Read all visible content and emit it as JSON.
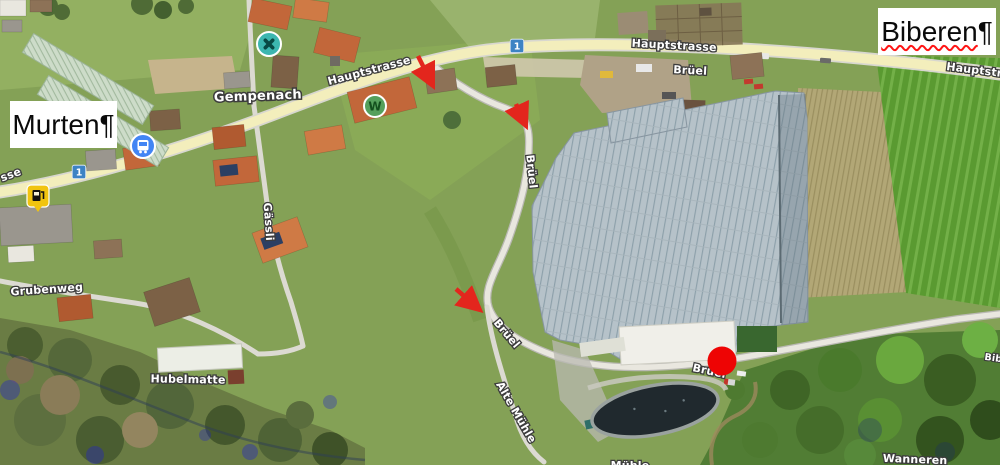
{
  "document": {
    "text_boxes": {
      "murten": {
        "word": "Murten",
        "pilcrow": "¶"
      },
      "biberen": {
        "word": "Biberen",
        "pilcrow": "¶",
        "misspelled": true
      }
    }
  },
  "map": {
    "locality_label": "Gempenach",
    "street_labels": {
      "hauptstrasse_west": "Hauptstrasse",
      "hauptstrasse_north": "Hauptstrasse",
      "hauptstrasse_east_partial": "Hauptstra",
      "strasse_left_partial": "sse",
      "brueel_north": "Brüel",
      "brueel_upper": "Brüel",
      "brueel_mid": "Brüel",
      "brueel_at_marker": "Brüel",
      "gaessli": "Gässli",
      "grubenweg": "Grubenweg",
      "hubelmatte": "Hubelmatte",
      "alte_muehle": "Alte Mühle",
      "muehle_bottom_partial": "Mühle",
      "wanneren": "Wanneren",
      "bibere_right_partial": "Bib"
    },
    "route_shield_number": "1",
    "poi": {
      "w_badge": "W"
    }
  },
  "theme": {
    "arrow_red": "#e3261d",
    "marker_red": "#ee0404",
    "squiggle_red": "#ff1515",
    "road_yellow": "#f3eebc",
    "shield_blue": "#3d83c4",
    "restaurant_teal": "#3cb6b0",
    "poi_green": "#55a05c",
    "bus_blue": "#4285f4",
    "fuel_yellow": "#f1c40f",
    "label_fill": "#ffffff",
    "label_halo": "#3c3c3c"
  }
}
